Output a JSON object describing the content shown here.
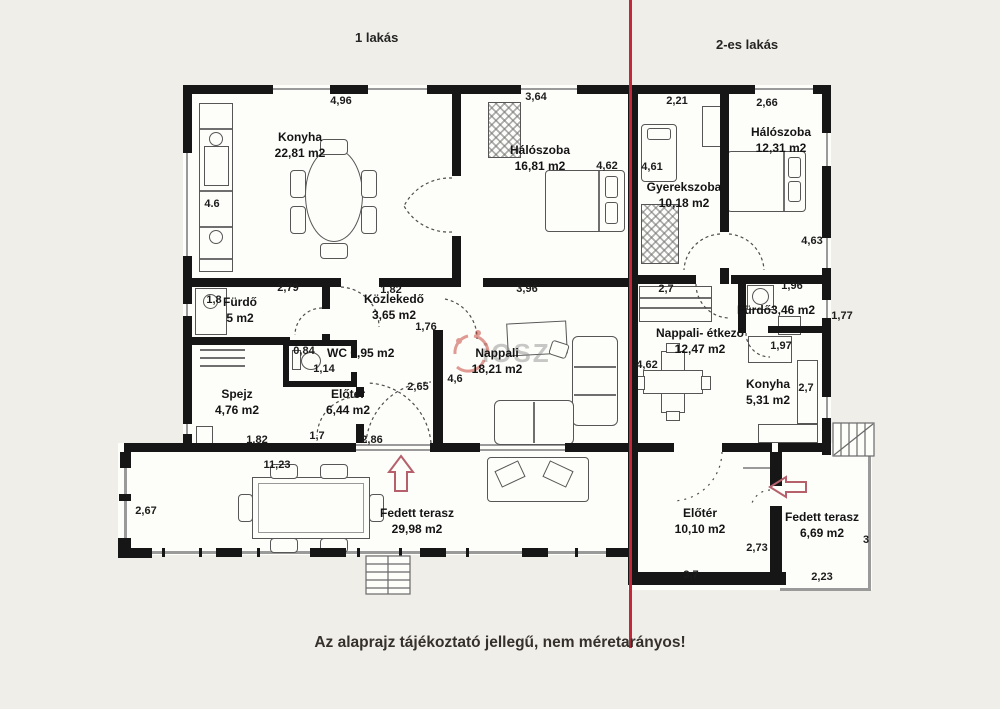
{
  "header": {
    "apartment1_label": "1 lakás",
    "apartment2_label": "2-es lakás"
  },
  "footer": {
    "disclaimer": "Az alaprajz tájékoztató jellegű, nem méretarányos!"
  },
  "watermark": {
    "text": "iOSZ"
  },
  "rooms": [
    {
      "name": "Konyha",
      "area": "22,81 m2"
    },
    {
      "name": "Hálószoba",
      "area": "16,81 m2"
    },
    {
      "name": "Gyerekszoba",
      "area": "10,18 m2"
    },
    {
      "name": "Hálószoba",
      "area": "12,31 m2"
    },
    {
      "name": "Fürdő",
      "area": "5 m2"
    },
    {
      "name": "Közlekedő",
      "area": "3,65 m2"
    },
    {
      "name": "WC",
      "area": "0,95 m2"
    },
    {
      "name": "Nappali",
      "area": "18,21 m2"
    },
    {
      "name": "Nappali- étkező",
      "area": "12,47 m2"
    },
    {
      "name": "Fürdő",
      "area": "3,46 m2"
    },
    {
      "name": "Konyha",
      "area": "5,31 m2"
    },
    {
      "name": "Spejz",
      "area": "4,76 m2"
    },
    {
      "name": "Előtér",
      "area": "6,44 m2"
    },
    {
      "name": "Fedett terasz",
      "area": "29,98 m2"
    },
    {
      "name": "Előtér",
      "area": "10,10 m2"
    },
    {
      "name": "Fedett terasz",
      "area": "6,69 m2"
    }
  ],
  "dims": {
    "konyha_w": "4,96",
    "halo1_w": "3,64",
    "gyerek_w": "2,21",
    "halo2_w": "2,66",
    "konyha_h": "4.6",
    "halo1_h": "4,62",
    "gyerek_h": "4,61",
    "halo2_h": "4,63",
    "furdo1_w": "2,79",
    "furdo1_h": "1,8",
    "kozlekedo_w": "1,82",
    "kozlekedo_d": "1,76",
    "nappali_w": "3,96",
    "etkezo_w": "2,7",
    "furdo2_w": "1,96",
    "furdo2_h": "1,77",
    "wc_w": "0,84",
    "wc_h": "1,14",
    "eloter1_h": "2,65",
    "nappali_h": "4,6",
    "etkezo_h": "4,62",
    "konyha2_w": "1,97",
    "konyha2_h": "2,7",
    "spejz_w": "1,82",
    "eloter1_w1": "1,7",
    "eloter1_w2": "2,86",
    "terasz1_w": "11,23",
    "terasz1_h": "2,67",
    "eloter2_h": "2,73",
    "eloter2_w": "3,7",
    "terasz2_w": "2,23",
    "terasz2_h": "3"
  }
}
